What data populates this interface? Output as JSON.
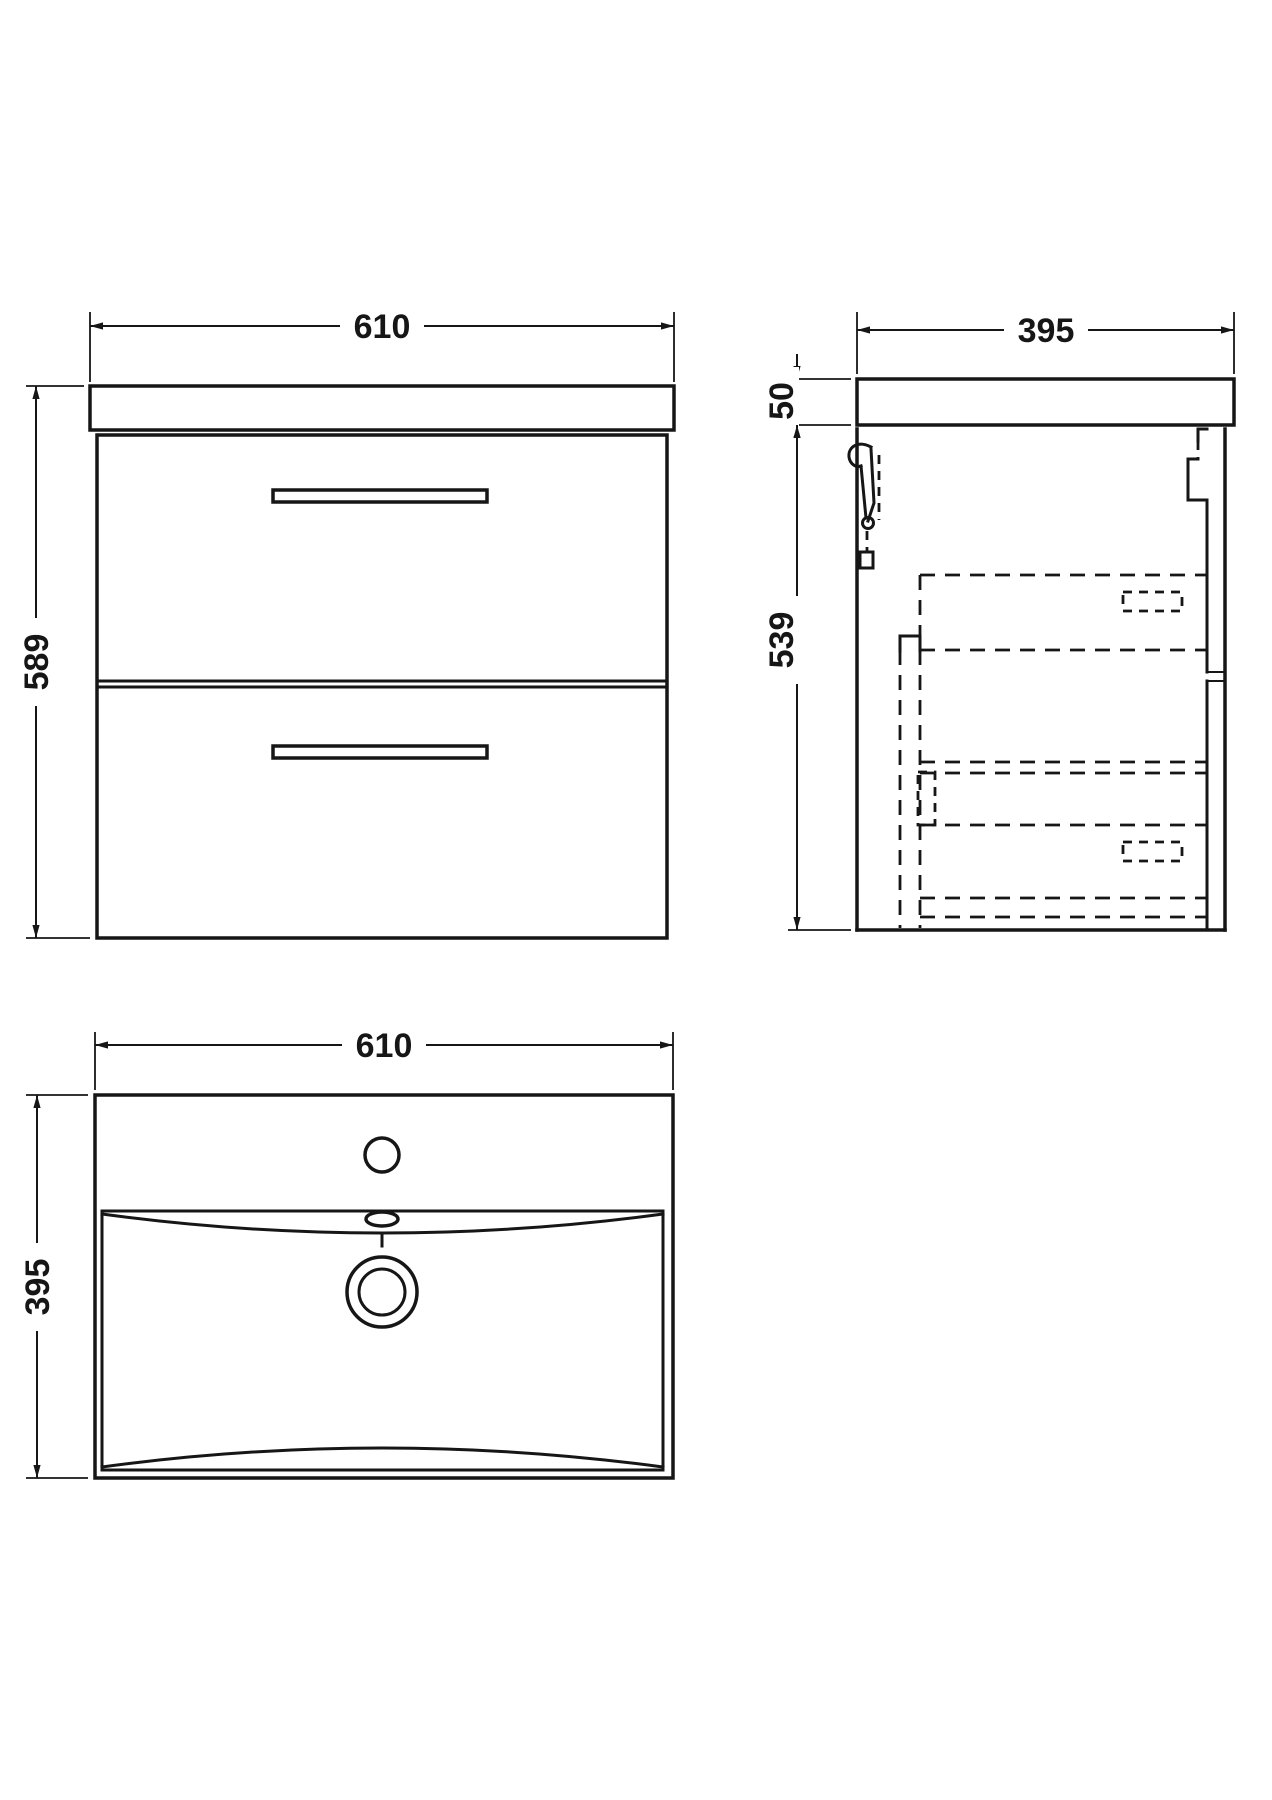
{
  "colors": {
    "ink": "#161616",
    "paper": "#ffffff"
  },
  "views": {
    "front": {
      "width": "610",
      "height": "589"
    },
    "side": {
      "depth": "395",
      "worktop_height": "50",
      "cabinet_height": "539"
    },
    "plan": {
      "width": "610",
      "depth": "395"
    }
  }
}
